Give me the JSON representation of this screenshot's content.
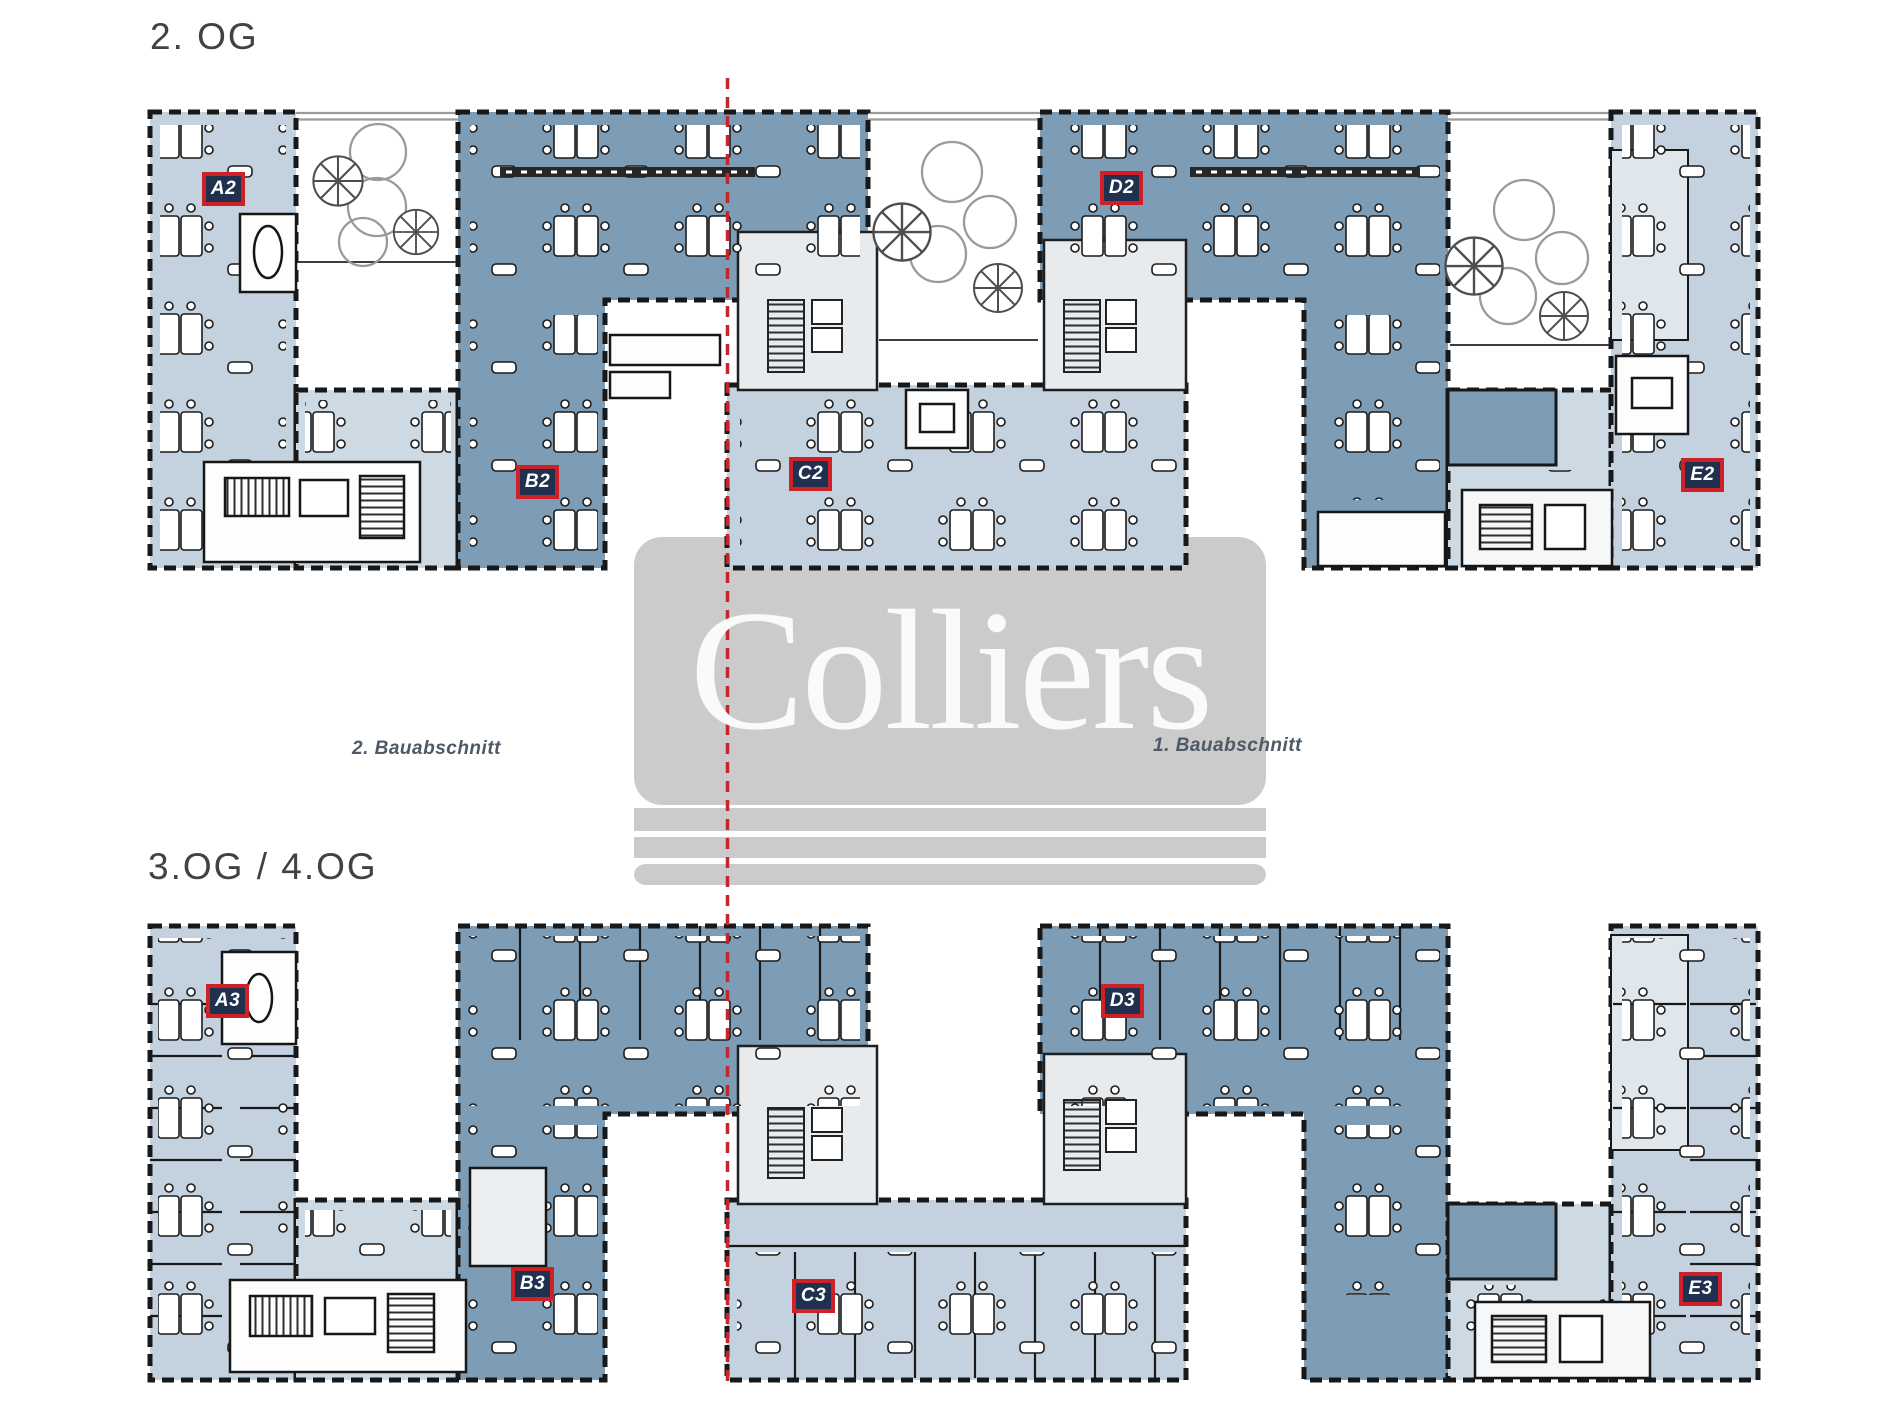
{
  "document": {
    "kind": "office-floor-plan-sheet",
    "brand": "Colliers"
  },
  "titles": {
    "floor_2": "2. OG",
    "floor_3_4": "3.OG / 4.OG"
  },
  "phase_labels": {
    "phase_2": "2. Bauabschnitt",
    "phase_1": "1. Bauabschnitt"
  },
  "watermark": {
    "text": "Colliers"
  },
  "units": {
    "floor_2": [
      {
        "id": "A2",
        "x": 223,
        "y": 189
      },
      {
        "id": "B2",
        "x": 537,
        "y": 482
      },
      {
        "id": "C2",
        "x": 810,
        "y": 474
      },
      {
        "id": "D2",
        "x": 1121,
        "y": 188
      },
      {
        "id": "E2",
        "x": 1702,
        "y": 475
      }
    ],
    "floor_3_4": [
      {
        "id": "A3",
        "x": 227,
        "y": 1001
      },
      {
        "id": "B3",
        "x": 532,
        "y": 1284
      },
      {
        "id": "C3",
        "x": 813,
        "y": 1296
      },
      {
        "id": "D3",
        "x": 1122,
        "y": 1001
      },
      {
        "id": "E3",
        "x": 1700,
        "y": 1289
      }
    ]
  },
  "colors": {
    "unit_dark_blue": "#7d9cb5",
    "unit_light_blue": "#c3d2de",
    "unit_pale_blue": "#cddae4",
    "core_gray": "#e8ebee",
    "label_navy": "#20304f",
    "label_border_red": "#ce2127",
    "phase_line_red": "#c2272e",
    "watermark_gray": "#cbcbcb",
    "title_text": "#3f4346",
    "phase_text": "#4e5a66"
  }
}
